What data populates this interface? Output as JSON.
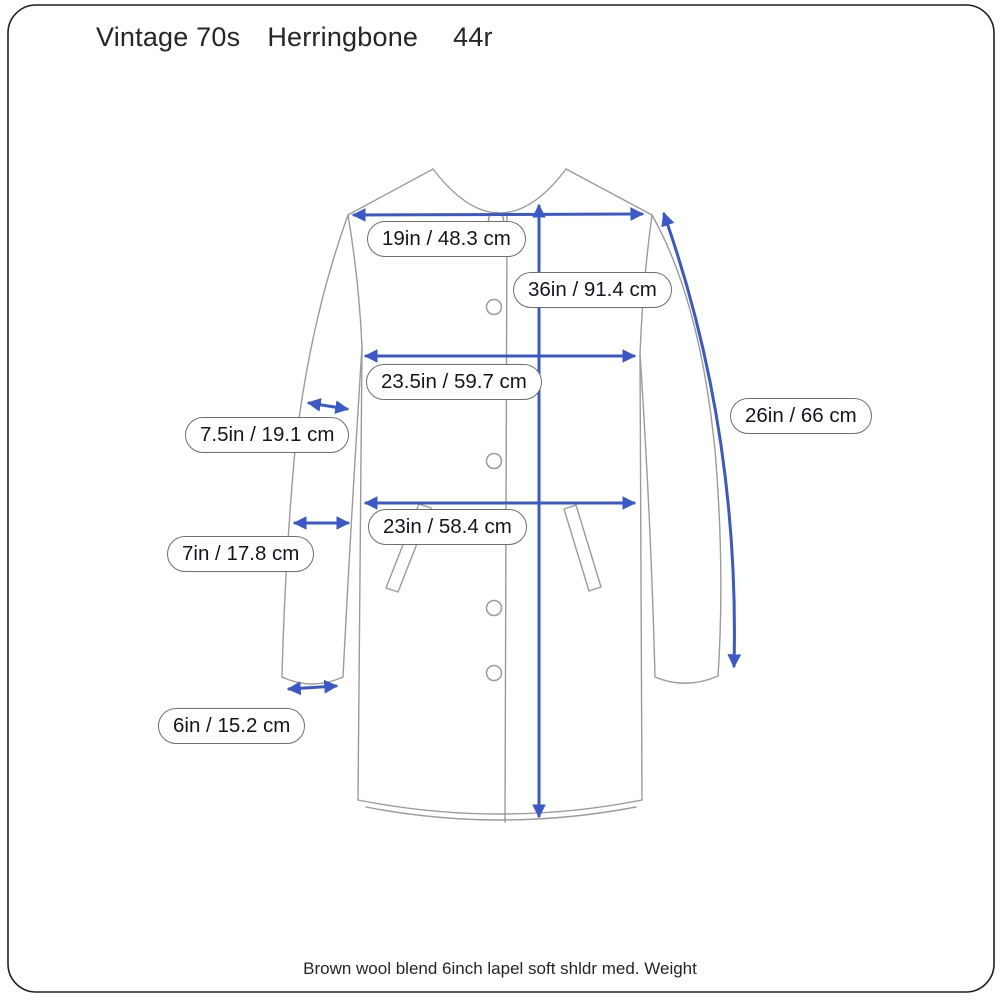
{
  "title": {
    "part1": "Vintage 70s",
    "part2": "Herringbone",
    "part3": "44r"
  },
  "footer": {
    "text": "Brown wool blend 6inch lapel soft shldr med. Weight"
  },
  "colors": {
    "arrow_blue": "#3a58c8",
    "outline_gray": "#9b9b9b",
    "frame_black": "#1f1f1f",
    "label_text": "#15151f",
    "background": "#ffffff"
  },
  "diagram": {
    "subject": "collarless long coat line drawing with measurement arrows",
    "measurements": [
      {
        "id": "shoulder",
        "label": "19in / 48.3 cm"
      },
      {
        "id": "length",
        "label": "36in / 91.4 cm"
      },
      {
        "id": "chest",
        "label": "23.5in / 59.7 cm"
      },
      {
        "id": "bicep",
        "label": "7.5in / 19.1 cm"
      },
      {
        "id": "sleeve",
        "label": "26in / 66 cm"
      },
      {
        "id": "waist",
        "label": "23in / 58.4 cm"
      },
      {
        "id": "forearm",
        "label": "7in / 17.8 cm"
      },
      {
        "id": "cuff",
        "label": "6in / 15.2 cm"
      }
    ]
  }
}
